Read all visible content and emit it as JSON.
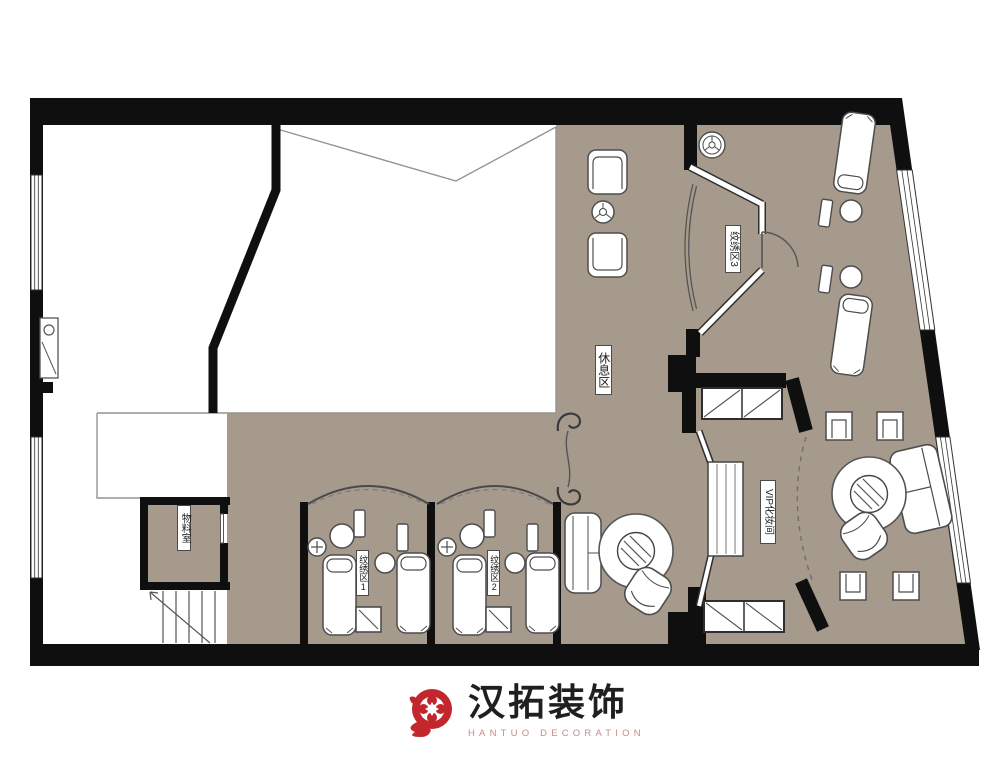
{
  "floor_plan": {
    "rooms": [
      {
        "id": "rest-area",
        "label": "休息区"
      },
      {
        "id": "tattoo-area-1",
        "label": "纹绣区1"
      },
      {
        "id": "tattoo-area-2",
        "label": "纹绣区2"
      },
      {
        "id": "tattoo-area-3",
        "label": "纹绣区3"
      },
      {
        "id": "vip-makeup-room",
        "label": "VIP化妆间"
      },
      {
        "id": "material-room",
        "label": "物料室"
      }
    ],
    "colors": {
      "floor": "#a69a8c",
      "wall": "#0f0f0f",
      "furniture_outline": "#4d4d4d"
    }
  },
  "logo": {
    "title": "汉拓装饰",
    "tagline": "HANTUO DECORATION",
    "brand_red": "#c1272d"
  }
}
